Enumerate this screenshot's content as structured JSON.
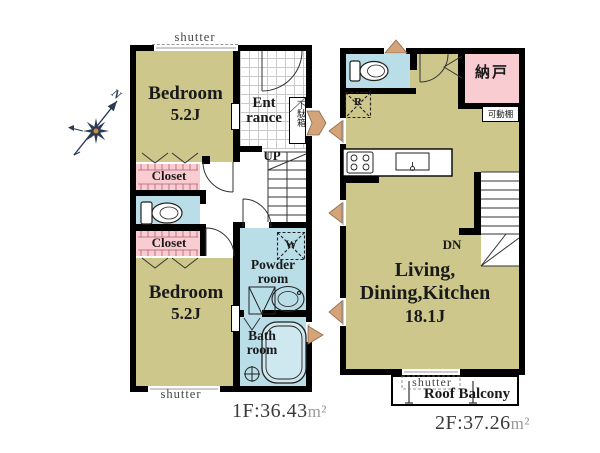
{
  "colors": {
    "room_fill": "#cdc78c",
    "wet_area_fill": "#b9dee8",
    "closet_fill": "#f8ccd1",
    "wall": "#000000",
    "opening_arrow": "#d4a37a",
    "compass": "#2b3b55",
    "area_label": "#3a3a3a",
    "unit_gray": "#999999"
  },
  "compass": {
    "north": "N"
  },
  "floor1": {
    "shutter_top": "shutter",
    "shutter_bottom": "shutter",
    "bedroom1": {
      "name": "Bedroom",
      "size": "5.2J"
    },
    "bedroom2": {
      "name": "Bedroom",
      "size": "5.2J"
    },
    "closet1": "Closet",
    "closet2": "Closet",
    "entrance": {
      "line1": "Ent",
      "line2": "rance"
    },
    "shoe_cabinet": "下駄箱",
    "up": "UP",
    "washer": "W",
    "powder": {
      "line1": "Powder",
      "line2": "room"
    },
    "bath": {
      "line1": "Bath",
      "line2": "room"
    },
    "area": "1F:36.43",
    "area_unit": "m²"
  },
  "floor2": {
    "storage": "納戸",
    "movable_shelf": "可動棚",
    "fridge": "R",
    "dn": "DN",
    "ldk": {
      "line1": "Living,",
      "line2": "Dining,Kitchen",
      "line3": "18.1J"
    },
    "shutter": "shutter",
    "balcony": "Roof Balcony",
    "area": "2F:37.26",
    "area_unit": "m²"
  }
}
